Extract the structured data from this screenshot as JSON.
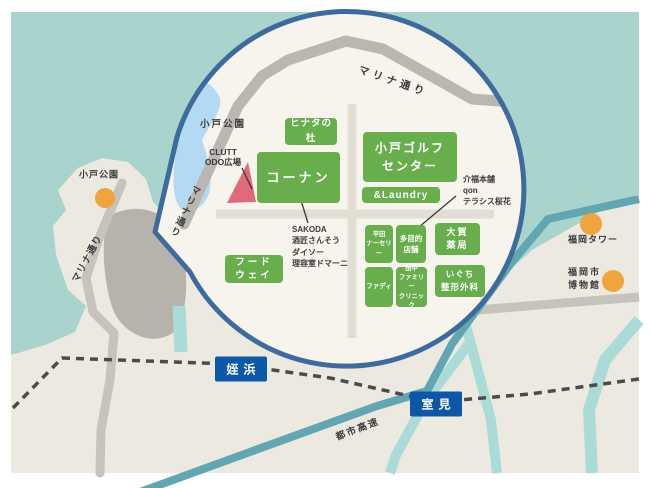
{
  "title": "小戸エリア案内マップ",
  "bubble": {
    "places": [
      {
        "id": "hinata",
        "label": "ヒナタの杜"
      },
      {
        "id": "konan",
        "label": "コーナン"
      },
      {
        "id": "golf",
        "label": "小戸ゴルフ\nセンター"
      },
      {
        "id": "laundry",
        "label": "&Laundry"
      },
      {
        "id": "hirata",
        "label": "平田\nナーセリー"
      },
      {
        "id": "tamokuteki",
        "label": "多目的\n店舗"
      },
      {
        "id": "oga",
        "label": "大賀\n薬局"
      },
      {
        "id": "fadi",
        "label": "ファディ"
      },
      {
        "id": "tanaka",
        "label": "田中\nファミリー\nクリニック"
      },
      {
        "id": "iguchi",
        "label": "いぐち\n整形外科"
      },
      {
        "id": "foodway",
        "label": "フード\nウェイ"
      }
    ],
    "annotations": {
      "park": "小戸公園",
      "clutt": "CLUTT\nODO広場",
      "sakoda": "SAKODA\n酒匠さんそう\nダイソー\n理容室ドマーニ",
      "kaifuku": "介福本舗\nqon\nテラシス桜花",
      "marina_top": "マリナ通り",
      "marina_left": "マリナ通り"
    }
  },
  "base": {
    "odo_park": "小戸公園",
    "marina_street": "マリナ通り",
    "expressway": "都市高速",
    "landmarks": [
      {
        "id": "fukuoka_tower",
        "label": "福岡タワー"
      },
      {
        "id": "fukuoka_museum",
        "label": "福岡市\n博物館"
      }
    ],
    "stations": [
      {
        "id": "meinohama",
        "label": "姪浜"
      },
      {
        "id": "muromi",
        "label": "室見"
      }
    ]
  },
  "colors": {
    "water": "#a9d4cd",
    "land": "#ebe9e0",
    "bubble_fill": "#f7f4ed",
    "bubble_border": "#3e6b9d",
    "place_green": "#68ae4c",
    "station_blue": "#0d57a7",
    "landmark_orange": "#efa43d",
    "plaza_red": "#e0697a",
    "pond_blue": "#b4d9f3",
    "road_gray": "#c6c3bd",
    "expressway_teal": "#61a6b1",
    "river_teal": "#aadbd7",
    "railway_gray": "#4b4b4b"
  }
}
